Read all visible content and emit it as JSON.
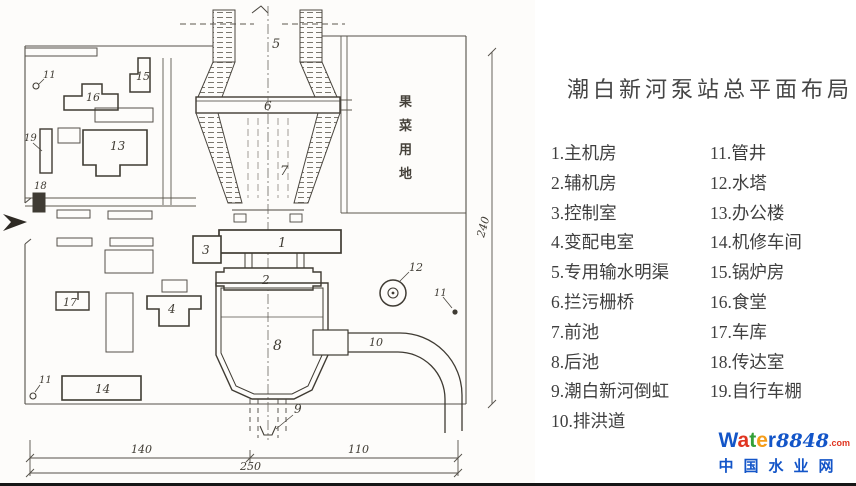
{
  "panel": {
    "title": "潮白新河泵站总平面布局",
    "legend_left": [
      "1.主机房",
      "2.辅机房",
      "3.控制室",
      "4.变配电室",
      "5.专用输水明渠",
      "6.拦污栅桥",
      "7.前池",
      "8.后池",
      "9.潮白新河倒虹",
      "10.排洪道"
    ],
    "legend_right": [
      "11.管井",
      "12.水塔",
      "13.办公楼",
      "14.机修车间",
      "15.锅炉房",
      "16.食堂",
      "17.车库",
      "18.传达室",
      "19.自行车棚"
    ]
  },
  "plan": {
    "area_note": "果菜用地",
    "area_note_chars": [
      "果",
      "菜",
      "用",
      "地"
    ],
    "labels": {
      "n1": "1",
      "n2": "2",
      "n3": "3",
      "n4": "4",
      "n5": "5",
      "n6": "6",
      "n7": "7",
      "n8": "8",
      "n9": "9",
      "n10": "10",
      "n11": "11",
      "n12": "12",
      "n13": "13",
      "n14": "14",
      "n15": "15",
      "n16": "16",
      "n17": "17",
      "n18": "18",
      "n19": "19"
    },
    "dims": {
      "w_left": "140",
      "w_right": "110",
      "w_total": "250",
      "h_right": "240"
    }
  },
  "logo": {
    "word_letters": [
      "W",
      "a",
      "t",
      "e",
      "r"
    ],
    "number": "8848",
    "tld": ".com",
    "tagline": "中国水业网",
    "colors": {
      "blue": "#1355c8",
      "red": "#e03420",
      "green": "#33a038",
      "orange": "#f59d1a"
    }
  }
}
